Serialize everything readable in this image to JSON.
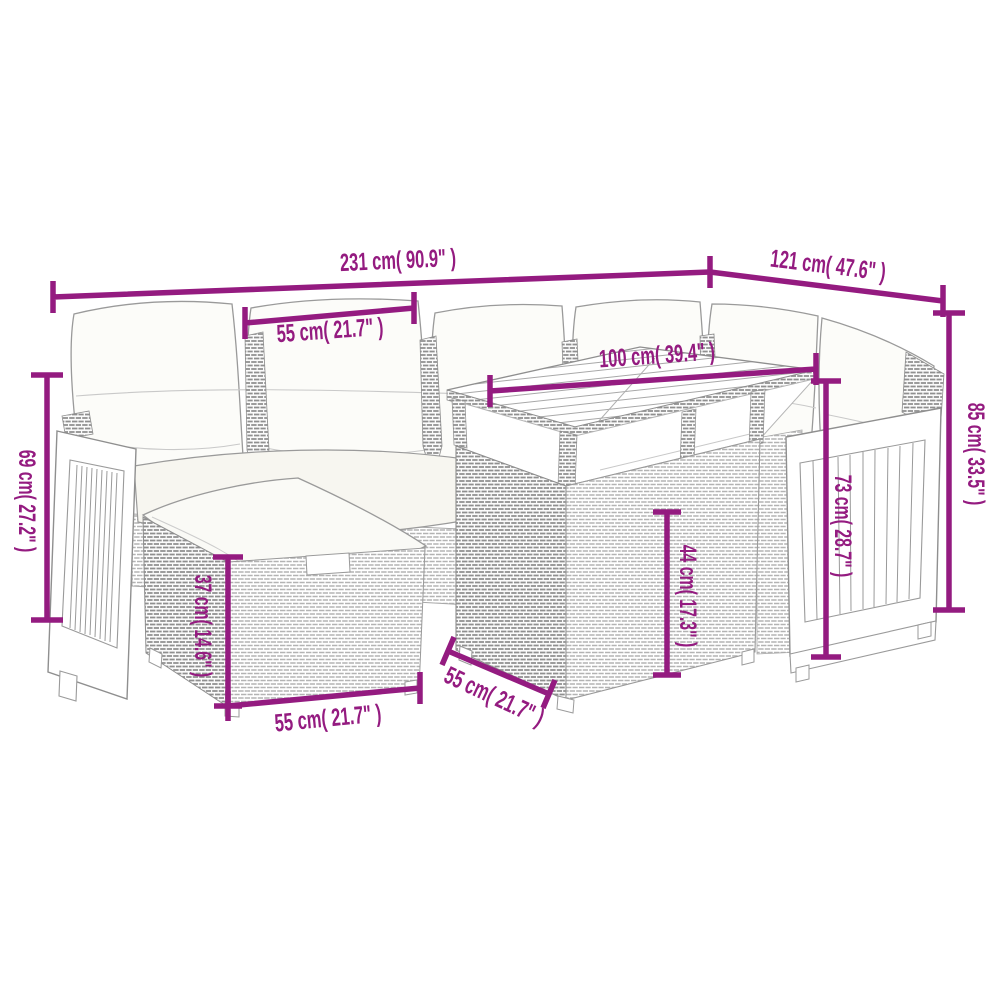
{
  "image": {
    "type": "product dimension diagram",
    "subject": "7-piece poly rattan garden lounge set with cushions, table and footstool",
    "background_color": "#ffffff",
    "dimension_color": "#941b80",
    "sketch_color": "#9a9a9a"
  },
  "dimensions": {
    "total_width": {
      "label": "231 cm( 90.9\" )"
    },
    "right_section_depth": {
      "label": "121 cm( 47.6\" )"
    },
    "seat_width": {
      "label": "55 cm( 21.7\" )"
    },
    "table_top_width": {
      "label": "100 cm( 39.4\" )"
    },
    "back_height": {
      "label": "85 cm( 33.5\" )"
    },
    "arm_height": {
      "label": "73 cm( 28.7\" )"
    },
    "left_arm_height": {
      "label": "69 cm( 27.2\" )"
    },
    "footstool_height": {
      "label": "37 cm( 14.6\" )"
    },
    "footstool_width": {
      "label": "55 cm( 21.7\" )"
    },
    "table_depth": {
      "label": "55 cm( 21.7\" )"
    },
    "table_base_height": {
      "label": "44 cm( 17.3\" )"
    }
  }
}
